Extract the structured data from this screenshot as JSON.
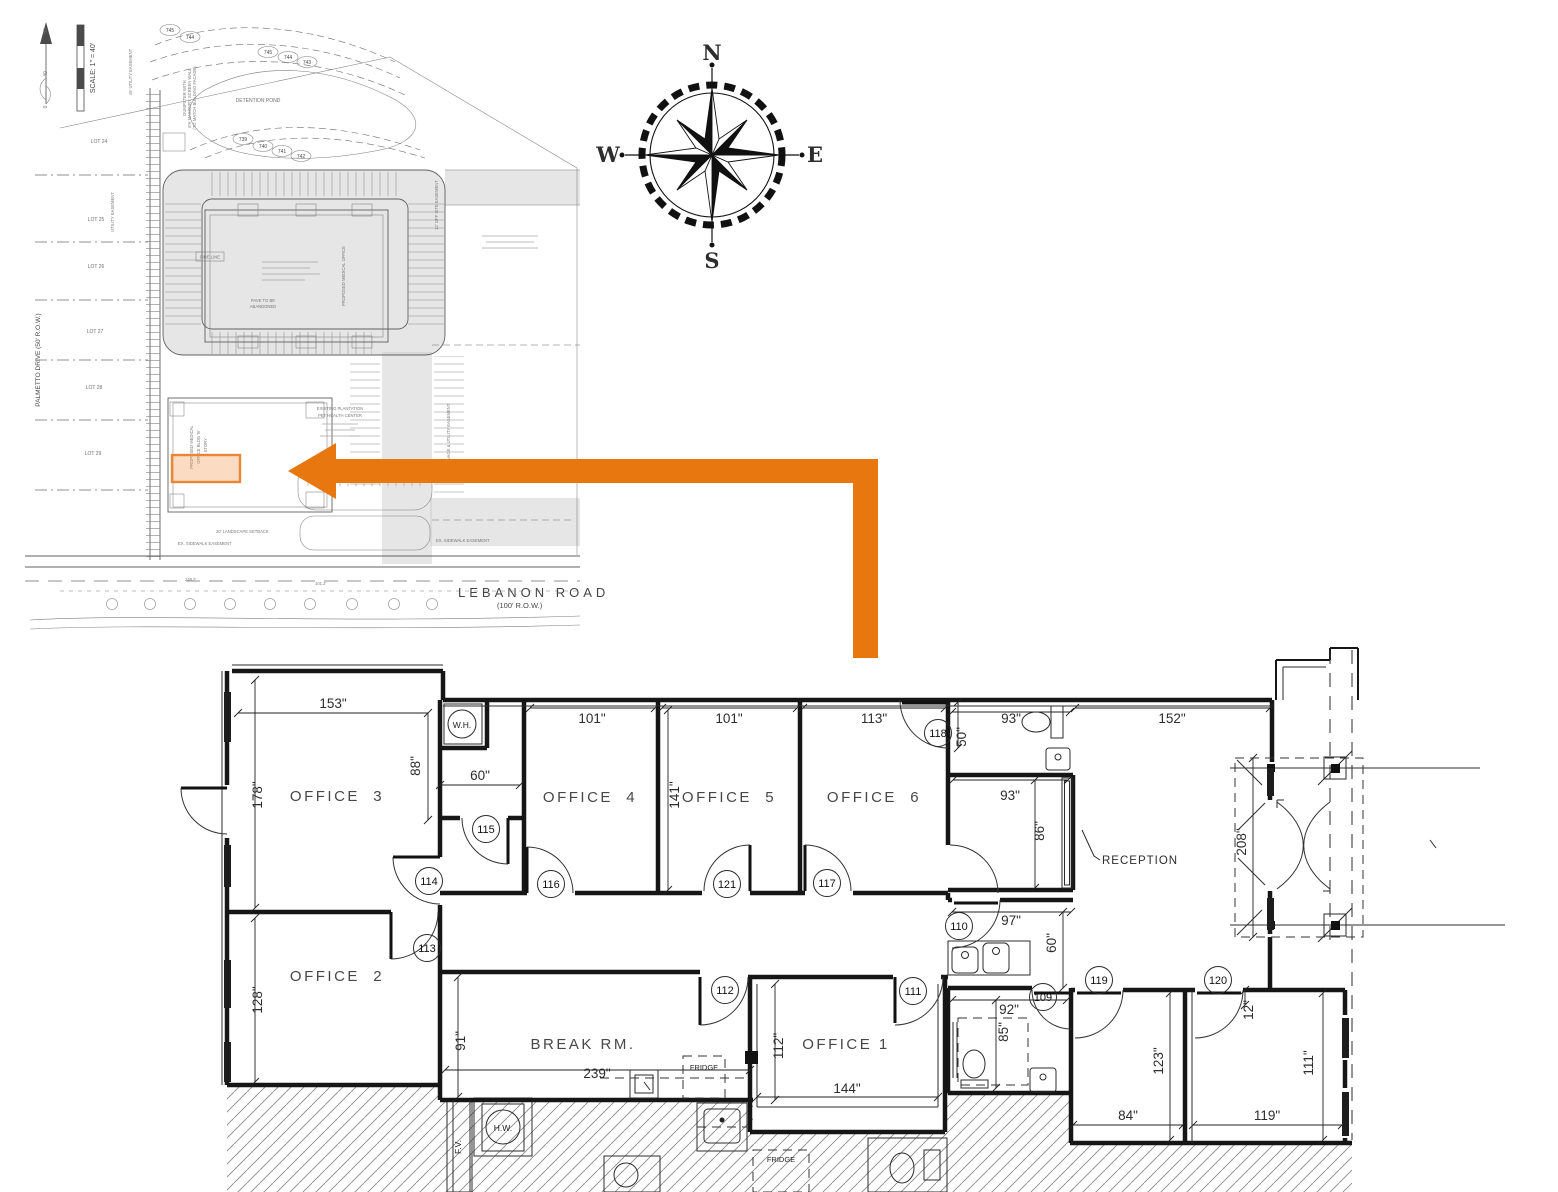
{
  "colors": {
    "highlight_orange": "#E8771A",
    "arrow_orange": "#E8770F"
  },
  "compass": {
    "n": "N",
    "e": "E",
    "s": "S",
    "w": "W"
  },
  "site_plan": {
    "scale_label": "SCALE: 1\" = 40'",
    "scale_ticks": [
      "0",
      "40",
      "80"
    ],
    "lots": [
      "LOT 24",
      "LOT 25",
      "LOT 26",
      "LOT 27",
      "LOT 28",
      "LOT 29"
    ],
    "palmetto": "PALMETTO DRIVE (50' R.O.W.)",
    "lebanon": "LEBANON ROAD",
    "lebanon_row": "(100' R.O.W.)",
    "detention_pond": "DETENTION POND",
    "pet_center": [
      "EXISTING PLANTATION",
      "PET HEALTH CENTER"
    ],
    "bldg_a": "PROPOSED MEDICAL OFFICE",
    "bldg_b": [
      "PROPOSED MEDICAL",
      "OFFICE BLDG 'B'",
      "1 STORY"
    ],
    "setback": "20' LANDSCAPE SETBACK",
    "sidewalk": "EX. SIDEWALK EASEMENT",
    "sidewalk2": "EX. SIDEWALK EASEMENT",
    "utility": "15' UTILITY EASEMENT",
    "utility2": "UTILITY EASEMENT",
    "offsite": "12' OFF SITE EASEMENT",
    "drainage": "DRAINAGE & UTILITY EASEMENT",
    "fire_line": "FIRE LINE",
    "pave": [
      "PAVE TO BE",
      "ABANDONED"
    ],
    "dumpster": [
      "DUMPSTER WITH",
      "8'H MASONRY SCREEN WALL",
      "(TO MATCH BUILDING FACADE)"
    ],
    "dim_a": "248.2'",
    "dim_b": "101.2'",
    "contour_tags": [
      "745",
      "744",
      "745",
      "744",
      "743",
      "739",
      "740",
      "741",
      "742"
    ]
  },
  "floor_plan": {
    "rooms": {
      "office1": "OFFICE 1",
      "office2": "OFFICE  2",
      "office3": "OFFICE  3",
      "office4": "OFFICE  4",
      "office5": "OFFICE  5",
      "office6": "OFFICE  6",
      "break_rm": "BREAK RM.",
      "reception": "RECEPTION"
    },
    "dims": {
      "office3_w": "153\"",
      "wh_h": "88\"",
      "closet_w": "60\"",
      "office3_h": "178\"",
      "office4_w": "101\"",
      "office5_w": "101\"",
      "office5_h": "141\"",
      "office6_w": "113\"",
      "rr1_w": "93\"",
      "rr1_h": "50\"",
      "storage_w": "93\"",
      "storage_h": "86\"",
      "east_w": "152\"",
      "vest_h": "208\"",
      "hall_w": "97\"",
      "hall_h": "60\"",
      "office2_h": "128\"",
      "break_h": "91\"",
      "break_w": "239\"",
      "office1_h": "112\"",
      "office1_w": "144\"",
      "rr2_w": "92\"",
      "rr2_h": "85\"",
      "rm119_h": "123\"",
      "rm119_w": "84\"",
      "rm120_w": "119\"",
      "rm120_h": "111\"",
      "rm120_o": "12\""
    },
    "tags": {
      "t109": "109",
      "t110": "110",
      "t111": "111",
      "t112": "112",
      "t113": "113",
      "t114": "114",
      "t115": "115",
      "t116": "116",
      "t117": "117",
      "t118": "118",
      "t119": "119",
      "t120": "120",
      "t121": "121"
    },
    "fixtures": {
      "wh": "W.H.",
      "hw": "H.W.",
      "fv": "F.V.",
      "fridge_a": "FRIDGE",
      "fridge_b": "FRIDGE"
    }
  }
}
